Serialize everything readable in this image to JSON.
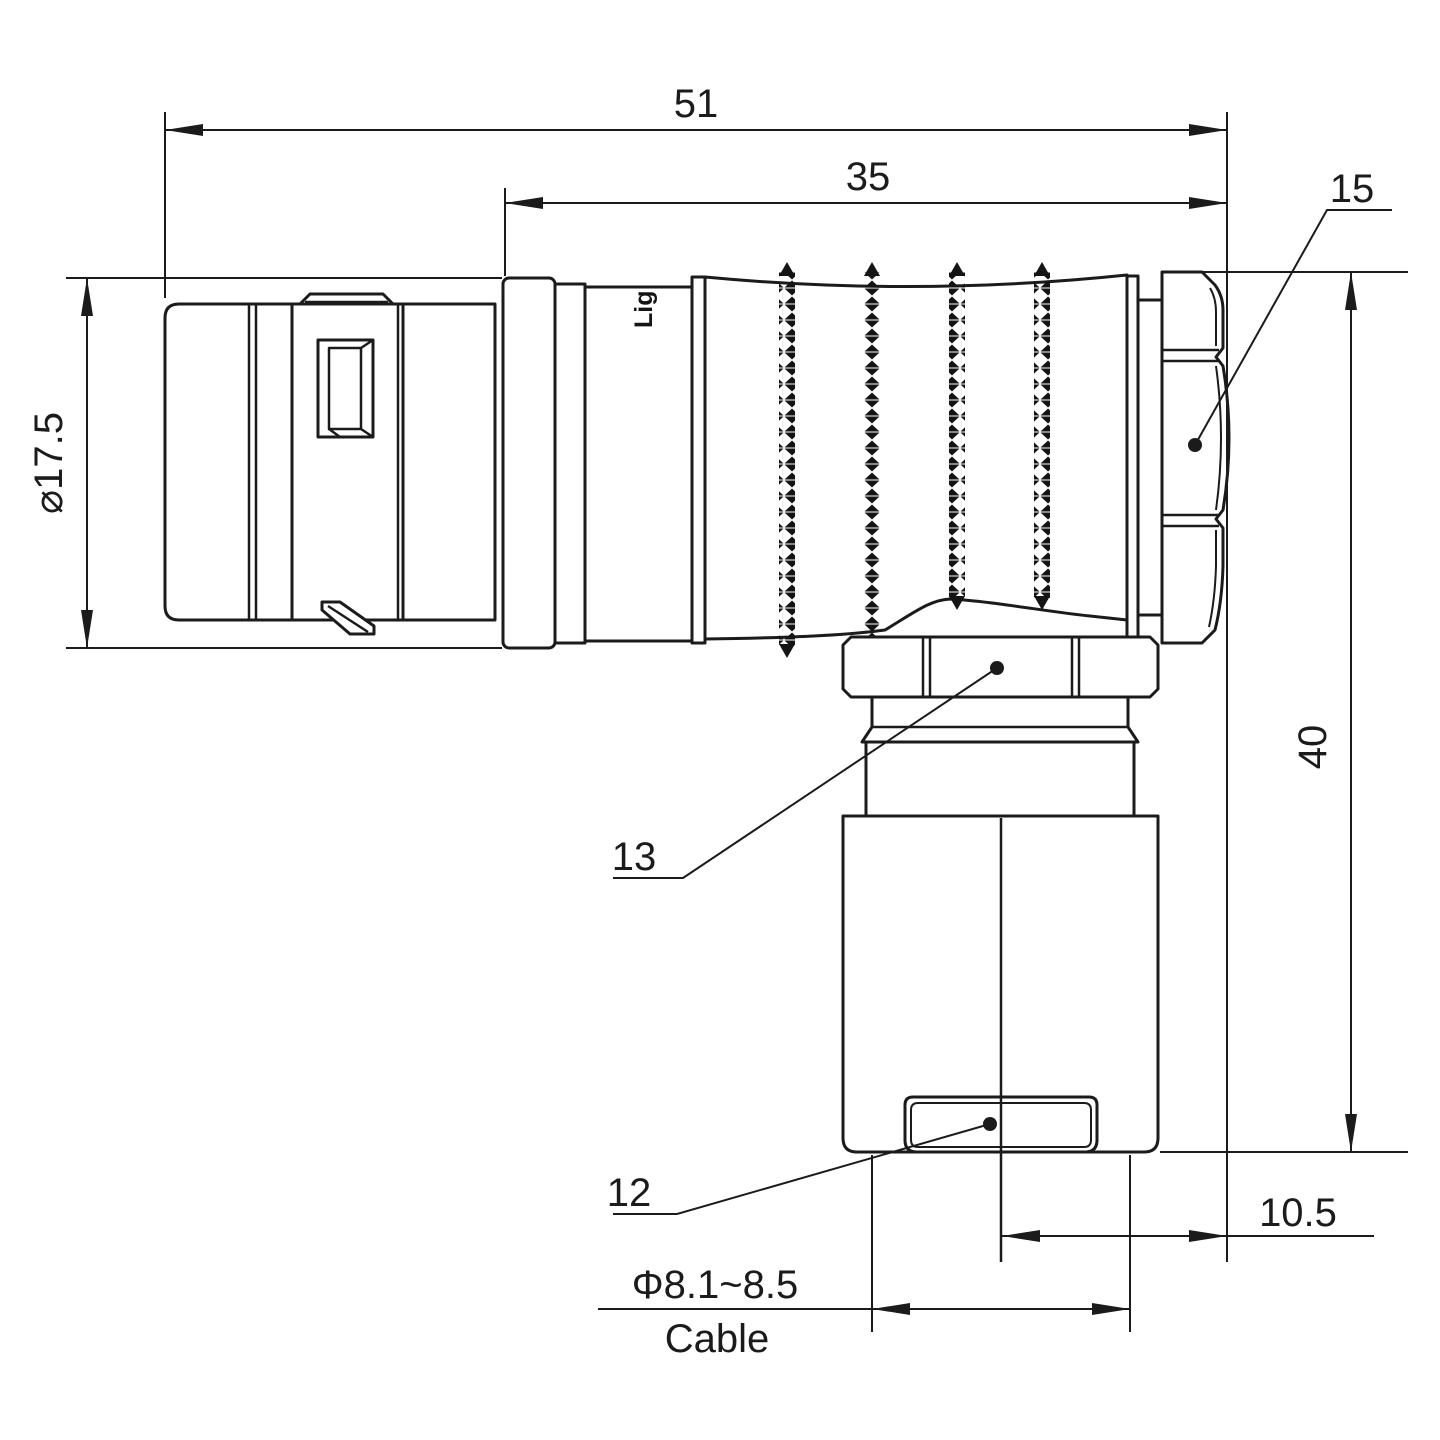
{
  "drawing": {
    "watermark": "Lightany",
    "brand_mark": "Lig",
    "dimensions": {
      "overall_length": "51",
      "front_length": "35",
      "shell_diameter": "⌀17.5",
      "height": "40",
      "cable_offset": "10.5",
      "cable_diameter_range": "Φ8.1~8.5",
      "cable_label": "Cable"
    },
    "items": {
      "backshell_nut": "15",
      "coupling_nut": "13",
      "cable_clamp": "12"
    }
  }
}
